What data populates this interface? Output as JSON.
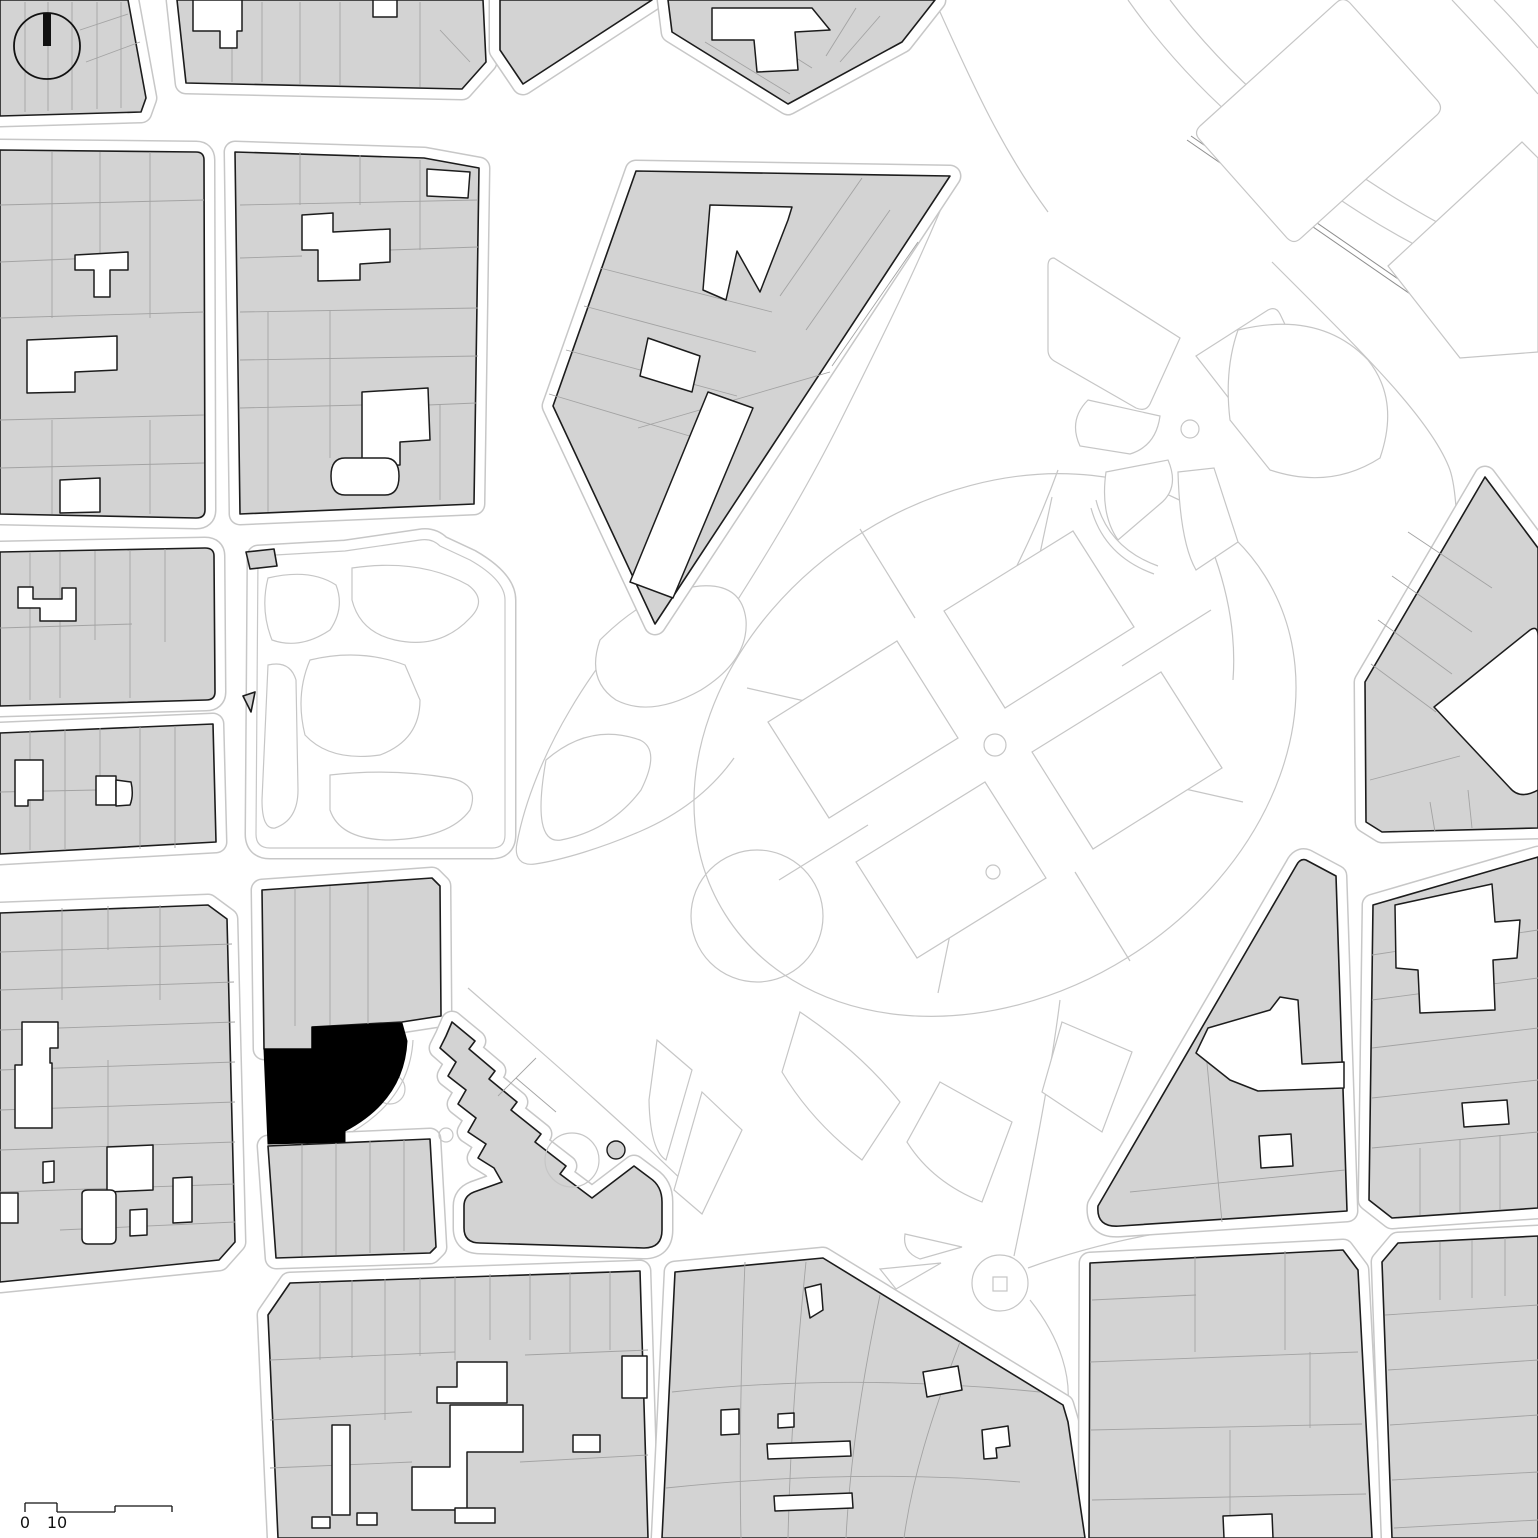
{
  "map": {
    "palette": {
      "background": "#ffffff",
      "block_fill": "#d3d3d3",
      "block_outline": "#1c1c1c",
      "parcel_line": "#a3a3a3",
      "park_line": "#c6c6c6",
      "curb_line": "#c7c7c7",
      "site_fill": "#000000",
      "annotation": "#111111"
    },
    "scale_bar": {
      "labels": [
        "0",
        "10"
      ]
    },
    "park": [
      {
        "cls": "parkline",
        "d": "M1128,0 C1190,88 1268,154 1362,214 C1422,252 1480,278 1538,298"
      },
      {
        "cls": "parkline",
        "d": "M1170,0 C1226,74 1302,140 1392,196 C1444,228 1494,252 1538,274"
      },
      {
        "cls": "parkline",
        "d": "M1452,0 C1482,32 1510,62 1538,94"
      },
      {
        "cls": "parkline",
        "d": "M1494,0 C1510,16 1524,32 1538,48"
      },
      {
        "cls": "wall",
        "d": "M1187,140 L1458,327"
      },
      {
        "cls": "wall",
        "d": "M1191,136 L1462,323"
      },
      {
        "cls": "parkline",
        "d": "M1272,262 C1362,352 1432,420 1450,470 C1462,506 1458,620 1448,668 C1440,704 1420,760 1398,802"
      },
      {
        "cls": "parkline",
        "d": "M1058,470 C1040,520 1020,560 1000,600"
      },
      {
        "cls": "parkline",
        "d": "M1215,557 C1230,600 1236,640 1233,680"
      },
      {
        "cls": "parkline",
        "d": "M952,182 C920,262 880,342 840,422 C800,502 750,582 702,655"
      },
      {
        "cls": "parkline",
        "d": "M940,12 C976,92 1004,152 1048,212"
      },
      {
        "cls": "parkline",
        "d": "M688,562 C640,610 598,662 570,710 C545,752 525,800 517,843 C514,858 521,866 535,864 C562,860 602,848 641,831 C680,814 712,789 734,758"
      },
      {
        "cls": "parkline",
        "d": "M468,988 C560,1068 642,1140 700,1198"
      },
      {
        "cls": "parkline",
        "d": "M1060,1000 C1050,1080 1030,1180 1014,1256"
      },
      {
        "cls": "parkline",
        "d": "M1028,1268 Q1120,1234 1240,1222"
      },
      {
        "cls": "parkline",
        "d": "M1030,1300 C1062,1340 1072,1380 1067,1410"
      },
      {
        "cls": "parkline",
        "d": "M725,914 A318,250 -32 1 0 1265,576 A318,250 -32 1 0 725,914 Z"
      },
      {
        "cls": "parkline",
        "d": "M1122,666 L1211,610"
      },
      {
        "cls": "parkline",
        "d": "M1141,779 L1243,802"
      },
      {
        "cls": "parkline",
        "d": "M1075,872 L1130,961"
      },
      {
        "cls": "parkline",
        "d": "M961,881 L938,993"
      },
      {
        "cls": "parkline",
        "d": "M868,825 L779,880"
      },
      {
        "cls": "parkline",
        "d": "M849,711 L747,688"
      },
      {
        "cls": "parkline",
        "d": "M915,618 L860,529"
      },
      {
        "cls": "parkline",
        "d": "M1029,605 L1052,497"
      },
      {
        "cls": "parkline",
        "d": "M1096,500 Q1108,548 1158,566"
      },
      {
        "cls": "parkline",
        "d": "M1091,508 Q1104,556 1154,574"
      },
      {
        "cls": "lawn",
        "d": "M1200,126 L1336,3 Q1343,-4 1350,3 L1437,100 Q1444,108 1437,115 L1301,238 Q1294,245 1287,238 L1200,140 Q1193,133 1200,126 Z"
      },
      {
        "cls": "lawn",
        "d": "M1388,266 L1522,142 L1538,158 L1538,352 L1460,358 Z"
      },
      {
        "cls": "lawn",
        "d": "M1054,258 L1180,338 L1150,404 Q1146,412 1136,408 L1056,362 Q1048,358 1048,350 L1048,266 Q1048,258 1054,258 Z"
      },
      {
        "cls": "lawn",
        "d": "M1196,356 L1268,310 Q1276,306 1280,314 L1302,360 L1238,410 Z"
      },
      {
        "cls": "lawn",
        "d": "M1088,400 L1160,416 Q1156,446 1130,454 L1080,446 Q1068,420 1088,400 Z"
      },
      {
        "cls": "lawn",
        "d": "M1106,472 L1168,460 Q1180,488 1160,504 L1118,540 Q1100,514 1106,472 Z"
      },
      {
        "cls": "lawn",
        "d": "M1178,472 L1214,468 L1238,542 L1196,570 Q1180,542 1178,472 Z"
      },
      {
        "cls": "lawn",
        "d": "M1238,330 Q1320,310 1368,360 Q1400,400 1380,458 Q1330,490 1270,470 L1230,420 Q1224,370 1238,330 Z"
      },
      {
        "cls": "lawn",
        "d": "M768,722 L897,641 L958,738 L829,818 Z"
      },
      {
        "cls": "lawn",
        "d": "M944,611 L1073,531 L1134,627 L1005,708 Z"
      },
      {
        "cls": "lawn",
        "d": "M1032,752 L1161,672 L1222,768 L1093,849 Z"
      },
      {
        "cls": "lawn",
        "d": "M856,862 L985,782 L1046,878 L917,958 Z"
      },
      {
        "cls": "lawn",
        "d": "M600,640 Q650,590 700,586 Q742,583 746,620 Q749,660 701,690 Q651,718 616,700 Q586,680 600,640 Z"
      },
      {
        "cls": "lawn",
        "d": "M546,760 Q590,722 640,740 Q661,750 641,790 Q611,830 561,840 Q531,845 546,760 Z"
      },
      {
        "cls": "lawn",
        "d": "M657,1040 L692,1070 L666,1160 Q650,1150 649,1100 Z"
      },
      {
        "cls": "lawn",
        "d": "M702,1092 L742,1130 L702,1214 L674,1190 Z"
      },
      {
        "cls": "lawn",
        "d": "M800,1012 Q860,1052 900,1102 L862,1160 Q812,1122 782,1072 Z"
      },
      {
        "cls": "lawn",
        "d": "M940,1082 L1012,1122 L982,1202 Q932,1182 907,1142 Z"
      },
      {
        "cls": "lawn",
        "d": "M1062,1022 L1132,1052 L1102,1132 L1042,1092 Z"
      },
      {
        "cls": "lawn",
        "d": "M905,1234 L962,1247 L920,1259 Q902,1252 905,1234 Z"
      },
      {
        "cls": "lawn",
        "d": "M880,1269 L941,1263 L896,1289 Z"
      },
      {
        "cls": "parkline",
        "d": "M1181,429 a9,9 0 1 0 18,0 a9,9 0 1 0 -18,0 Z"
      },
      {
        "cls": "parkline",
        "d": "M984,745 a11,11 0 1 0 22,0 a11,11 0 1 0 -22,0 Z"
      },
      {
        "cls": "parkline",
        "d": "M691,916 a66,66 0 1 0 132,0 a66,66 0 1 0 -132,0 Z"
      },
      {
        "cls": "parkline",
        "d": "M986,872 a7,7 0 1 0 14,0 a7,7 0 1 0 -14,0 Z"
      },
      {
        "cls": "parkline",
        "d": "M972,1283 a28,28 0 1 0 56,0 a28,28 0 1 0 -56,0 Z"
      },
      {
        "cls": "parkline",
        "d": "M993,1277 L1007,1277 L1007,1291 L993,1291 Z"
      }
    ],
    "blocks": [
      {
        "name": "block-top-1",
        "d": "M0,0 L128,0 L146,98 L141,112 L0,116 Z"
      },
      {
        "name": "block-top-2",
        "d": "M177,0 L483,0 L486,62 L462,89 L186,83 Z"
      },
      {
        "name": "block-top-3",
        "d": "M500,0 L652,0 L523,84 L500,50 Z"
      },
      {
        "name": "block-top-4",
        "d": "M668,0 L935,0 L902,42 L788,104 L672,32 Z"
      },
      {
        "name": "block-cathedral",
        "d": "M636,171 L950,176 L655,624 L553,406 Z"
      },
      {
        "name": "block-left-2a",
        "d": "M0,150 L196,152 Q204,152 204,160 L205,510 Q205,518 196,518 L0,514 Z"
      },
      {
        "name": "block-left-2b",
        "d": "M235,152 L424,158 L479,168 L474,504 L240,514 Z"
      },
      {
        "name": "block-left-3",
        "d": "M0,552 L205,548 Q214,548 214,556 L215,692 Q215,700 206,700 L0,706 Z"
      },
      {
        "name": "block-left-4",
        "d": "M0,733 L213,724 L216,842 L0,854 Z"
      },
      {
        "name": "block-left-5",
        "d": "M0,913 L208,905 L227,919 L235,1242 L219,1260 L0,1282 Z"
      },
      {
        "name": "block-site-upper",
        "d": "M262,890 L432,878 L440,886 L441,1016 L402,1022 L312,1027 L312,1049 L264,1049 Z"
      },
      {
        "name": "block-site-lower",
        "d": "M268,1146 L430,1139 L436,1247 L430,1253 L276,1258 Z"
      },
      {
        "name": "block-palace",
        "d": "M452,1022 L475,1041 L469,1049 L495,1071 L489,1079 L517,1102 L511,1110 L541,1134 L535,1142 L566,1166 L560,1174 L592,1198 L634,1166 L650,1178 Q662,1186 662,1202 L662,1230 Q662,1248 644,1248 L480,1243 Q464,1243 464,1228 L464,1206 Q464,1196 474,1192 L502,1182 L494,1168 L478,1158 L486,1144 L468,1132 L476,1118 L458,1104 L466,1090 L448,1076 L456,1062 L440,1048 L446,1036 Z"
      },
      {
        "name": "block-right-mid",
        "d": "M1485,477 L1538,548 L1538,828 L1382,832 L1366,822 L1365,682 Z"
      },
      {
        "name": "block-right-3",
        "d": "M1373,905 L1538,857 L1538,1208 L1392,1218 L1369,1200 Z"
      },
      {
        "name": "block-right-triangle",
        "d": "M1306,860 L1336,876 L1347,1211 L1120,1226 Q1096,1228 1098,1206 L1296,866 Q1300,858 1306,860 Z"
      },
      {
        "name": "block-bottom-1",
        "d": "M290,1283 L640,1271 L648,1538 L278,1538 L268,1315 Z"
      },
      {
        "name": "block-bottom-2",
        "d": "M675,1272 L823,1258 L1063,1405 L1068,1422 L1085,1538 L662,1538 Z"
      },
      {
        "name": "block-bottom-3",
        "d": "M1090,1263 L1343,1250 L1358,1270 L1372,1538 L1089,1538 Z"
      },
      {
        "name": "block-bottom-4",
        "d": "M1398,1243 L1538,1236 L1538,1538 L1392,1538 L1382,1262 Z"
      },
      {
        "name": "garden-square",
        "cls": "garden",
        "d": "M258,556 L345,551 L420,540 Q432,538 440,546 L470,560 Q505,580 505,600 L505,835 Q505,848 492,848 L270,848 Q256,848 256,834 Z"
      },
      {
        "name": "garden-bit-1",
        "curb": false,
        "d": "M246,552 L274,549 L277,566 L250,569 Z"
      },
      {
        "name": "garden-bit-2",
        "curb": false,
        "d": "M243,696 L255,692 L251,712 Z"
      }
    ],
    "parcels": [
      "M25,2 V112",
      "M48,2 V111",
      "M72,2 V110",
      "M97,2 V109",
      "M121,2 V108",
      "M80,30 L128,14",
      "M86,62 L140,42",
      "M232,2 V82",
      "M262,2 V82",
      "M300,2 V84",
      "M340,2 V85",
      "M420,2 V87",
      "M440,30 L470,62",
      "M705,42 L790,94",
      "M733,18 L812,68",
      "M856,8 L826,56",
      "M880,16 L840,62",
      "M600,268 L772,312",
      "M584,306 L756,352",
      "M566,350 L737,396",
      "M549,394 L703,440",
      "M862,178 L780,296",
      "M890,210 L806,330",
      "M918,242 L832,366",
      "M638,428 L830,372",
      "M0,205 L204,200",
      "M0,262 L95,258",
      "M0,318 L204,312",
      "M0,420 L204,415",
      "M0,468 L204,463",
      "M52,152 V318",
      "M100,152 V260",
      "M150,152 V318",
      "M52,420 V514",
      "M150,420 V514",
      "M240,205 L478,200",
      "M240,258 L302,256",
      "M390,250 L478,247",
      "M240,312 L478,308",
      "M240,360 L478,356",
      "M240,408 L362,405",
      "M428,405 L476,403",
      "M300,152 V205",
      "M360,155 V205",
      "M420,160 V250",
      "M268,312 V512",
      "M330,310 V458",
      "M440,405 V500",
      "M30,553 V700",
      "M60,552 V698",
      "M95,551 V640",
      "M130,550 V698",
      "M165,549 V642",
      "M0,628 L132,624",
      "M30,730 V850",
      "M65,729 V850",
      "M100,728 V800",
      "M140,727 V849",
      "M175,726 V848",
      "M0,792 L96,790",
      "M0,952 L232,944",
      "M0,990 L234,982",
      "M0,1030 L235,1022",
      "M0,1070 L235,1062",
      "M0,1110 L235,1102",
      "M0,1150 L235,1142",
      "M0,1192 L235,1184",
      "M60,1230 L235,1222",
      "M62,908 V1000",
      "M108,906 V950",
      "M160,905 V1000",
      "M108,1060 V1148",
      "M295,888 V1026",
      "M330,886 V1025",
      "M368,884 V1024",
      "M302,1144 V1256",
      "M336,1143 V1255",
      "M370,1141 V1253",
      "M404,1140 V1251",
      "M1408,532 L1492,588",
      "M1392,576 L1472,632",
      "M1378,620 L1452,674",
      "M1371,664 L1436,712",
      "M1370,780 L1460,756",
      "M1430,802 L1435,832",
      "M1468,790 L1472,828",
      "M1372,955 L1538,930",
      "M1372,1000 L1538,978",
      "M1372,1048 L1538,1028",
      "M1372,1098 L1538,1080",
      "M1372,1148 L1538,1132",
      "M1420,1148 V1215",
      "M1460,1140 V1212",
      "M1500,1135 V1210",
      "M1130,1192 L1345,1170",
      "M1205,1042 L1222,1222",
      "M320,1282 V1360",
      "M352,1280 V1358",
      "M385,1279 V1420",
      "M420,1277 V1356",
      "M455,1276 V1360",
      "M490,1274 V1340",
      "M530,1273 V1340",
      "M570,1272 V1352",
      "M610,1271 V1350",
      "M270,1360 L455,1352",
      "M270,1420 L412,1412",
      "M270,1468 L412,1462",
      "M520,1462 L648,1455",
      "M525,1355 L648,1350",
      "M745,1262 C741,1360 739,1450 741,1538",
      "M806,1262 C796,1360 790,1450 788,1538",
      "M880,1295 C862,1380 850,1460 846,1538",
      "M960,1342 C930,1420 912,1480 904,1538",
      "M672,1392 C780,1380 900,1378 1040,1392",
      "M666,1488 C780,1476 900,1472 1020,1482",
      "M1195,1256 V1352",
      "M1285,1251 V1350",
      "M1092,1300 L1196,1295",
      "M1090,1362 L1358,1352",
      "M1091,1430 L1362,1424",
      "M1092,1500 L1366,1494",
      "M1230,1430 V1538",
      "M1310,1352 V1428",
      "M1440,1242 V1300",
      "M1472,1240 V1298",
      "M1505,1238 V1296",
      "M1385,1315 L1538,1305",
      "M1388,1370 L1538,1360",
      "M1390,1425 L1538,1415",
      "M1392,1480 L1538,1472",
      "M1394,1528 L1538,1520",
      "M516,1078 L556,1112",
      "M536,1058 L498,1096"
    ],
    "buildings": [
      "M193,0 L242,0 L242,31 L237,31 L237,48 L220,48 L220,31 L193,31 Z",
      "M373,0 L397,0 L397,17 L373,17 Z",
      "M712,8 L812,8 L830,30 L795,32 L798,70 L757,72 L754,40 L712,40 Z",
      "M710,205 L792,207 L788,220 L760,292 L737,251 L726,300 L703,290 Z",
      "M648,338 L700,356 L692,392 L640,376 Z",
      "M708,392 L753,408 L673,598 L630,582 Z",
      "M75,255 L128,252 L128,270 L110,270 L110,297 L94,297 L94,270 L75,270 Z",
      "M27,340 L117,336 L117,370 L75,372 L75,392 L27,393 Z",
      "M60,480 L100,478 L100,512 L60,513 Z",
      "M302,215 L333,213 L333,232 L390,229 L390,262 L360,264 L360,280 L318,281 L318,250 L302,250 Z",
      "M362,392 L428,388 L430,440 L400,442 L400,465 L362,466 Z",
      "M345,458 L385,458 Q399,458 399,476 Q399,495 385,495 L345,495 Q331,495 331,476 Q331,458 345,458 Z",
      "M427,169 L470,172 L468,198 L427,196 Z",
      "M18,587 L33,587 L33,599 L62,599 L62,588 L76,588 L76,621 L40,621 L40,608 L18,608 Z",
      "M15,760 L43,760 L43,800 L28,800 L28,806 L15,806 Z",
      "M96,776 L116,776 L116,805 L96,805 Z",
      "M116,780 L131,782 Q134,795 130,805 L116,806 Z",
      "M22,1022 L58,1022 L58,1048 L50,1048 L50,1063 L52,1063 L52,1128 L15,1128 L15,1065 L22,1065 Z",
      "M107,1147 L153,1145 L153,1190 L107,1192 Z",
      "M82,1194 Q82,1190 88,1190 L110,1190 Q116,1190 116,1196 L116,1238 Q116,1244 110,1244 L88,1244 Q82,1244 82,1238 Z",
      "M130,1210 L147,1209 L147,1235 L130,1236 Z",
      "M173,1178 L192,1177 L192,1222 L173,1223 Z",
      "M0,1193 L18,1193 L18,1223 L0,1223 Z",
      "M43,1162 L54,1161 L54,1182 L43,1183 Z",
      "M1434,707 L1530,630 Q1538,625 1538,636 L1538,790 Q1520,800 1510,788 Z",
      "M1395,905 L1492,884 L1495,922 L1520,920 L1517,958 L1493,960 L1495,1010 L1420,1013 L1418,970 L1396,968 Z",
      "M1462,1103 L1507,1100 L1509,1124 L1464,1127 Z",
      "M1208,1028 L1270,1010 L1280,997 L1298,1000 L1302,1064 L1344,1062 L1344,1088 L1258,1091 L1230,1080 L1196,1053 Z",
      "M1259,1136 L1291,1134 L1293,1166 L1261,1168 Z",
      "M437,1387 L457,1387 L457,1362 L507,1362 L507,1403 L437,1403 Z",
      "M450,1405 L523,1405 L523,1452 L467,1452 L467,1510 L412,1510 L412,1467 L450,1467 Z",
      "M455,1508 L495,1508 L495,1523 L455,1523 Z",
      "M332,1425 L350,1425 L350,1515 L332,1515 Z",
      "M312,1517 L330,1517 L330,1528 L312,1528 Z",
      "M357,1513 L377,1513 L377,1525 L357,1525 Z",
      "M622,1356 L647,1356 L647,1398 L622,1398 Z",
      "M573,1435 L600,1435 L600,1452 L573,1452 Z",
      "M805,1288 L821,1284 L823,1310 L810,1318 Z",
      "M923,1372 L958,1366 L962,1390 L927,1397 Z",
      "M982,1430 L1008,1426 L1010,1446 L996,1448 L997,1458 L984,1459 Z",
      "M721,1410 L739,1409 L739,1434 L721,1435 Z",
      "M778,1414 L794,1413 L794,1427 L778,1428 Z",
      "M767,1444 L850,1441 L851,1456 L768,1459 Z",
      "M774,1496 L852,1493 L853,1508 L775,1511 Z",
      "M1223,1516 L1272,1514 L1273,1538 L1224,1538 Z"
    ],
    "details": [
      {
        "cls": "parkline",
        "d": "M413,1040 Q410,1098 352,1132"
      },
      {
        "cls": "parkline",
        "d": "M375,1089 a15,15 0 1 0 30,0 a15,15 0 1 0 -30,0 Z"
      },
      {
        "cls": "parkline",
        "d": "M439,1135 a7,7 0 1 0 14,0 a7,7 0 1 0 -14,0 Z"
      },
      {
        "cls": "parkline",
        "d": "M545,1160 a27,27 0 1 0 54,0 a27,27 0 1 0 -54,0 Z"
      },
      {
        "cls": "detail-dark",
        "d": "M607,1150 a9,9 0 1 0 18,0 a9,9 0 1 0 -18,0 Z"
      },
      {
        "cls": "parkline",
        "d": "M268,578 Q310,568 336,585 Q345,608 330,630 Q300,650 272,640 Q260,610 268,578 Z"
      },
      {
        "cls": "parkline",
        "d": "M352,568 Q420,558 468,585 Q488,600 470,618 Q440,650 395,640 Q360,632 352,600 Z"
      },
      {
        "cls": "parkline",
        "d": "M310,660 Q360,648 405,665 L420,700 Q420,740 380,755 Q330,762 305,735 Q295,695 310,660 Z"
      },
      {
        "cls": "parkline",
        "d": "M268,665 Q290,660 296,680 L298,790 Q298,820 275,828 Q262,830 262,800 Z"
      },
      {
        "cls": "parkline",
        "d": "M330,775 Q390,768 450,778 Q480,784 470,810 Q450,838 390,840 Q340,840 330,810 Z"
      }
    ],
    "site": {
      "name": "highlighted-site-building",
      "d": "M264,1049 L312,1049 L312,1027 L402,1023 L407,1041 Q404,1100 345,1131 L345,1142 L268,1144 Z"
    }
  }
}
